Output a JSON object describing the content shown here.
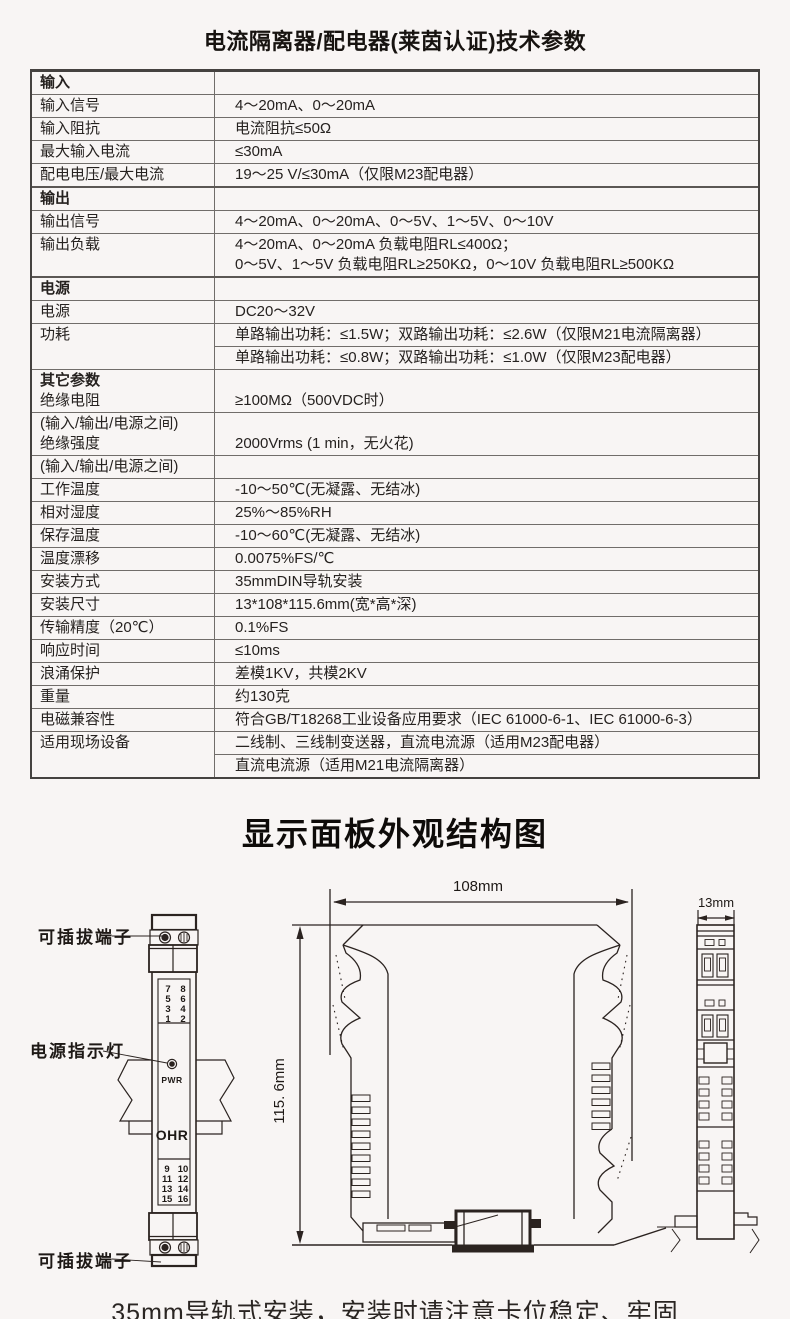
{
  "colors": {
    "background": "#f8f5f4",
    "ink": "#221c19",
    "line": "#2b2320",
    "table_border": "#454240"
  },
  "title": "电流隔离器/配电器(莱茵认证)技术参数",
  "spec_table": {
    "rows": [
      {
        "section": true,
        "label": "输入",
        "value": ""
      },
      {
        "label": "输入信号",
        "value": "4～20mA、0～20mA"
      },
      {
        "label": "输入阻抗",
        "value": "电流阻抗≤50Ω"
      },
      {
        "label": "最大输入电流",
        "value": "≤30mA"
      },
      {
        "label": "配电电压/最大电流",
        "value": "19～25 V/≤30mA（仅限M23配电器）"
      },
      {
        "section": true,
        "label": "输出",
        "value": ""
      },
      {
        "label": "输出信号",
        "value": "4～20mA、0～20mA、0～5V、1～5V、0～10V"
      },
      {
        "label": "输出负载",
        "value_lines": [
          "4～20mA、0～20mA 负载电阻RL≤400Ω；",
          "0～5V、1～5V 负载电阻RL≥250KΩ，0～10V 负载电阻RL≥500KΩ"
        ]
      },
      {
        "section": true,
        "label": "电源",
        "value": ""
      },
      {
        "label": "电源",
        "value": "DC20～32V"
      },
      {
        "label": "功耗",
        "value_rows": [
          "单路输出功耗：≤1.5W；双路输出功耗：≤2.6W（仅限M21电流隔离器）",
          "单路输出功耗：≤0.8W；双路输出功耗：≤1.0W（仅限M23配电器）"
        ]
      },
      {
        "label_lines": [
          {
            "text": "其它参数",
            "bold": true
          },
          {
            "text": "绝缘电阻",
            "bold": false
          }
        ],
        "value": "≥100MΩ（500VDC时）",
        "value_align": "end"
      },
      {
        "label_lines": [
          {
            "text": "(输入/输出/电源之间)",
            "bold": false
          },
          {
            "text": "绝缘强度",
            "bold": false
          }
        ],
        "value": "2000Vrms (1 min，无火花)",
        "value_align": "end"
      },
      {
        "label": "(输入/输出/电源之间)",
        "value": ""
      },
      {
        "label": "工作温度",
        "value": "-10～50℃(无凝露、无结冰)"
      },
      {
        "label": "相对湿度",
        "value": "25%～85%RH"
      },
      {
        "label": "保存温度",
        "value": "-10～60℃(无凝露、无结冰)"
      },
      {
        "label": "温度漂移",
        "value": "0.0075%FS/℃"
      },
      {
        "label": "安装方式",
        "value": "35mmDIN导轨安装"
      },
      {
        "label": "安装尺寸",
        "value": "13*108*115.6mm(宽*高*深)"
      },
      {
        "label": "传输精度（20℃）",
        "value": "0.1%FS"
      },
      {
        "label": "响应时间",
        "value": "≤10ms"
      },
      {
        "label": "浪涌保护",
        "value": "差模1KV，共模2KV"
      },
      {
        "label": "重量",
        "value": "约130克"
      },
      {
        "label": "电磁兼容性",
        "value": "符合GB/T18268工业设备应用要求（IEC 61000-6-1、IEC 61000-6-3）"
      },
      {
        "label": "适用现场设备",
        "value_rows": [
          "二线制、三线制变送器，直流电流源（适用M23配电器）",
          "直流电流源（适用M21电流隔离器）"
        ]
      }
    ]
  },
  "section2": {
    "title": "显示面板外观结构图"
  },
  "diagram": {
    "left_view": {
      "label_top_terminal": "可插拔端子",
      "label_power_led": "电源指示灯",
      "label_bottom_terminal": "可插拔端子",
      "led_label": "PWR",
      "brand": "OHR",
      "terminals_top": [
        [
          "7",
          "8"
        ],
        [
          "5",
          "6"
        ],
        [
          "3",
          "4"
        ],
        [
          "1",
          "2"
        ]
      ],
      "terminals_bottom": [
        [
          "9",
          "10"
        ],
        [
          "11",
          "12"
        ],
        [
          "13",
          "14"
        ],
        [
          "15",
          "16"
        ]
      ]
    },
    "dimensions": {
      "width": "108mm",
      "height": "115. 6mm",
      "depth": "13mm"
    }
  },
  "footer": {
    "line1": "35mm导轨式安装，安装时请注意卡位稳定、牢固",
    "line2": "请尽可能垂直安装，以利于仪表内部热量散发"
  }
}
